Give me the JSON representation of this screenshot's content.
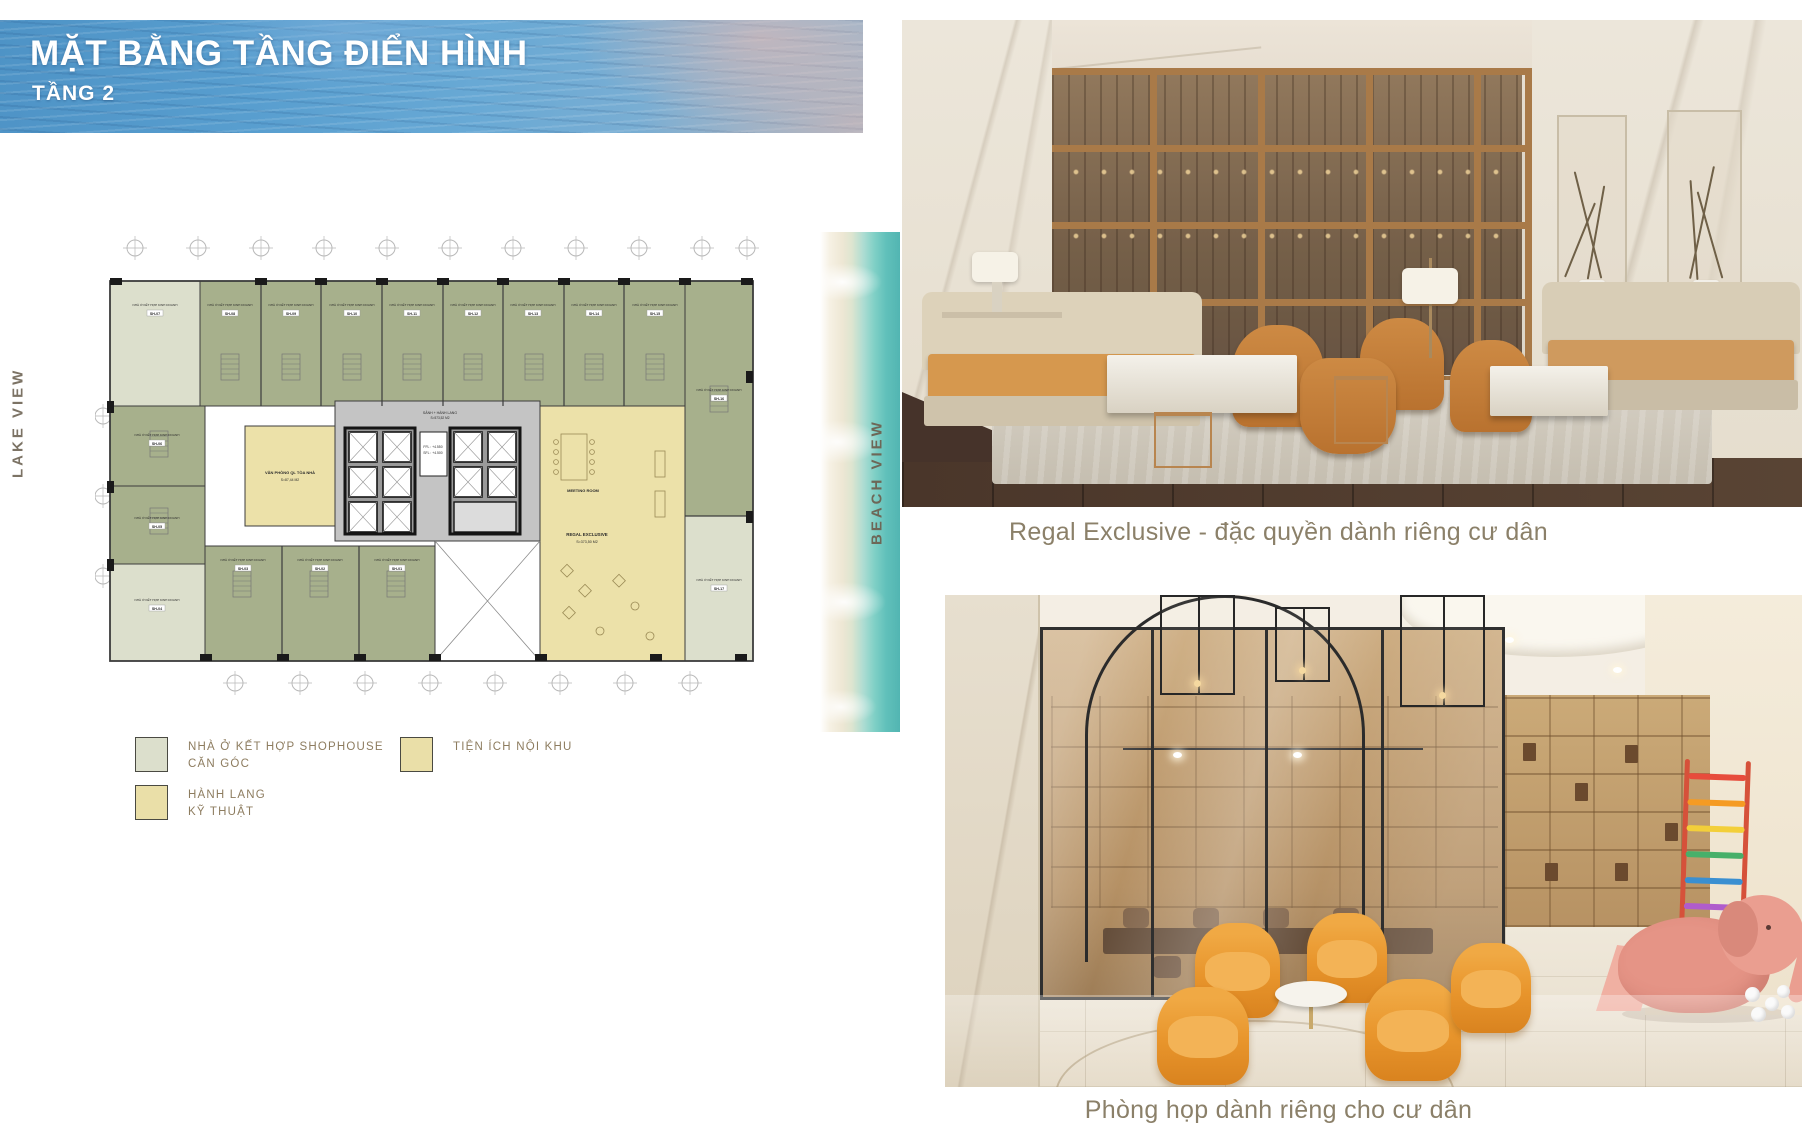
{
  "header": {
    "title": "MẶT BẰNG TẦNG ĐIỂN HÌNH",
    "subtitle": "TẦNG 2"
  },
  "side_labels": {
    "lake": "LAKE VIEW",
    "beach": "BEACH VIEW"
  },
  "floor_plan": {
    "unit_type_label": "NHÀ Ở KẾT HỢP KINH DOANH",
    "units": [
      "SH-07",
      "SH-08",
      "SH-09",
      "SH-10",
      "SH-11",
      "SH-12",
      "SH-13",
      "SH-14",
      "SH-15",
      "SH-16",
      "SH-17",
      "SH-06",
      "SH-05",
      "SH-04",
      "SH-03",
      "SH-02",
      "SH-01"
    ],
    "core": {
      "corridor_label": "SẢNH + HÀNH LANG",
      "corridor_area": "S=573,52 M2",
      "ffl": "FFL : +4.550",
      "sfl": "SFL : +4.500"
    },
    "office": {
      "name": "VĂN PHÒNG QL TÒA NHÀ",
      "area": "S=87,44 M2"
    },
    "amenity": {
      "meeting_room": "MEETING ROOM",
      "regal_name": "REGAL EXCLUSIVE",
      "regal_area": "S=373,50 M2"
    }
  },
  "legend": {
    "items": [
      {
        "line1": "NHÀ Ở KẾT HỢP SHOPHOUSE",
        "line2": "CĂN GÓC",
        "swatch_color": "#dcdfcc"
      },
      {
        "line1": "HÀNH LANG",
        "line2": "KỸ THUẬT",
        "swatch_color": "#eadfa8"
      },
      {
        "line1": "TIỆN ÍCH NỘI KHU",
        "line2": "",
        "swatch_color": "#eadfa8"
      }
    ]
  },
  "photos": [
    {
      "caption": "Regal Exclusive - đặc quyền dành riêng cư dân"
    },
    {
      "caption": "Phòng họp dành riêng cho cư dân"
    }
  ],
  "colors": {
    "unit_green": "#a7b08c",
    "unit_corner": "#dcdfcc",
    "amenity_yellow": "#ece1a9",
    "core_grey": "#c4c4c4",
    "legend_text": "#8d7c5f",
    "caption_text": "#8b8069",
    "water_blue": "#5a9ecb",
    "beach_teal": "#5bbcb8"
  }
}
